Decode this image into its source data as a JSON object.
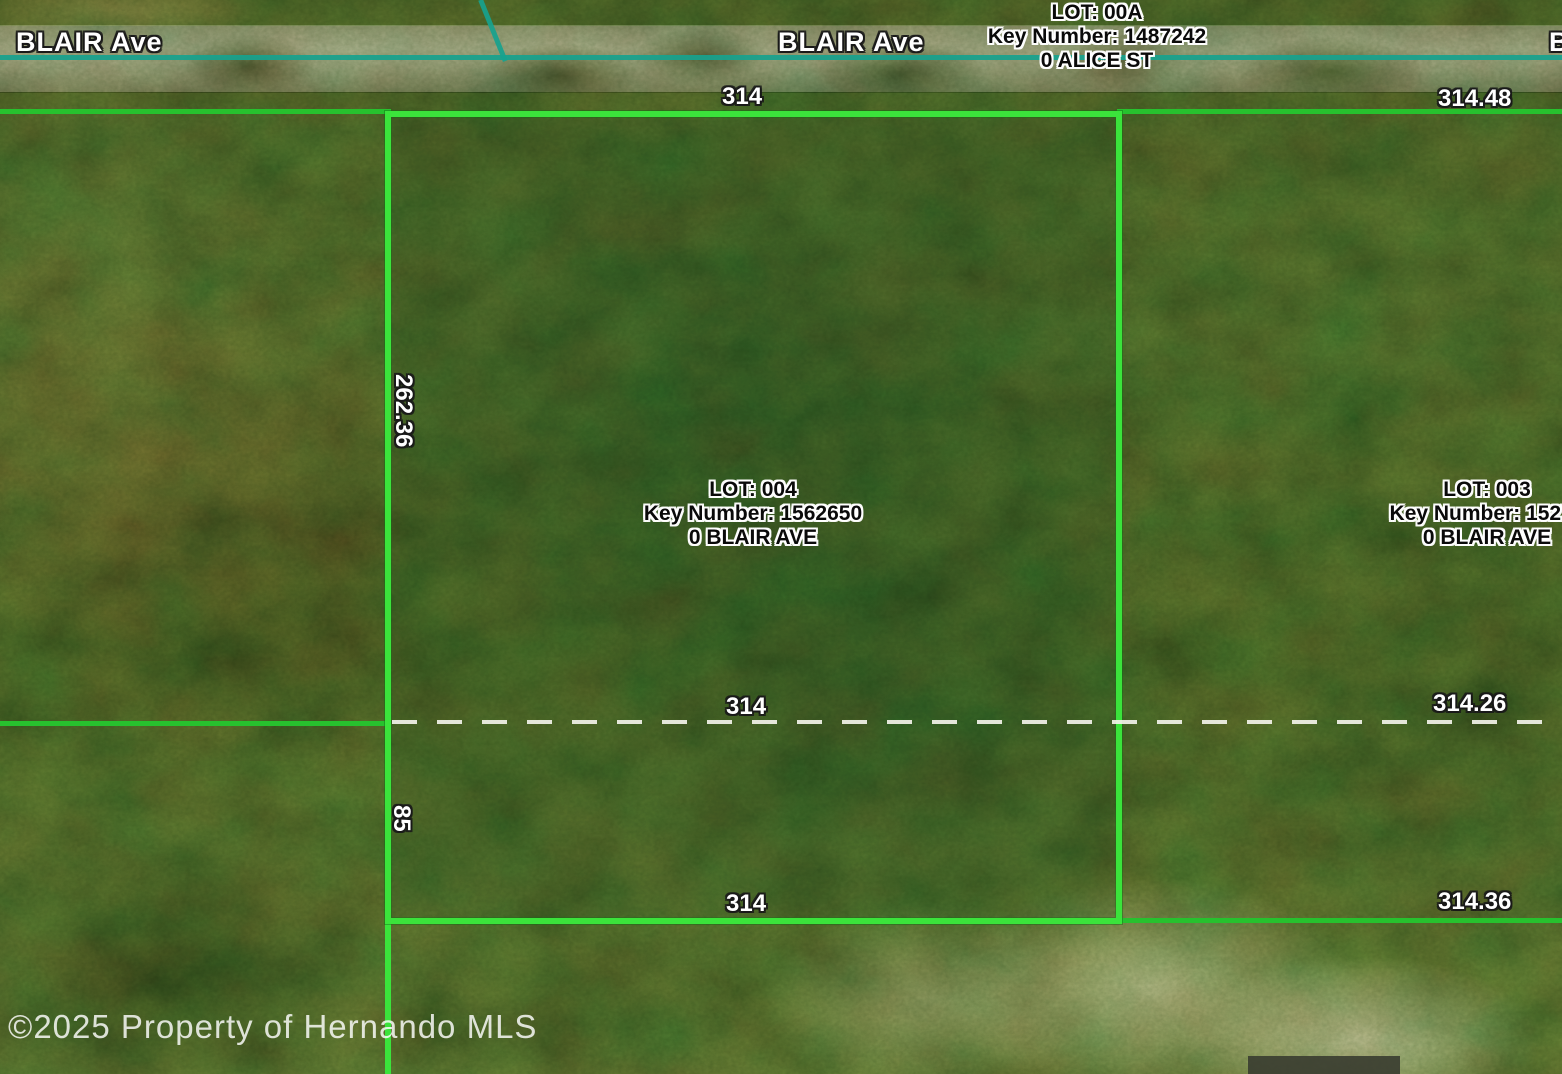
{
  "streets": {
    "blair_left": "BLAIR Ave",
    "blair_center": "BLAIR Ave",
    "blair_right_partial": "B"
  },
  "parcels": {
    "lot_00a": {
      "lot": "LOT: 00A",
      "key": "Key Number: 1487242",
      "address": "0 ALICE ST"
    },
    "lot_004": {
      "lot": "LOT: 004",
      "key": "Key Number: 1562650",
      "address": "0 BLAIR AVE"
    },
    "lot_003": {
      "lot": "LOT: 003",
      "key": "Key Number: 15273",
      "address": "0 BLAIR AVE"
    }
  },
  "dimensions": {
    "top_width": "314",
    "top_right_width": "314.48",
    "left_height": "262.36",
    "mid_width": "314",
    "mid_right_width": "314.26",
    "left_lower_height": "85",
    "bottom_width": "314",
    "bottom_right_width": "314.36"
  },
  "copyright": "©2025 Property of Hernando MLS",
  "colors": {
    "parcel_boundary": "#3be33b",
    "neighbor_boundary": "#27c12e",
    "road_centerline": "#17a28e",
    "dashed_lot_split": "#f2f2e9",
    "label_white": "#ffffff",
    "label_black": "#0a0a0a"
  }
}
